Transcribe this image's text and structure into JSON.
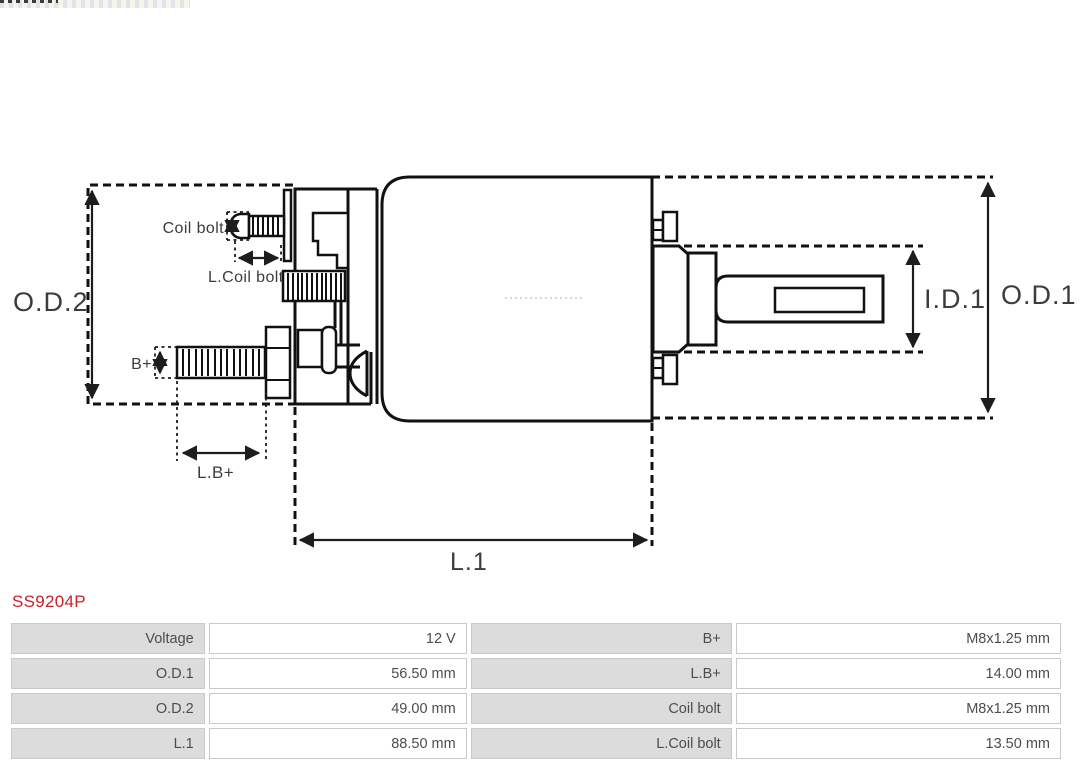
{
  "part_number": "SS9204P",
  "diagram": {
    "labels": {
      "od2": "O.D.2",
      "od1": "O.D.1",
      "id1": "I.D.1",
      "l1": "L.1",
      "b_plus": "B+",
      "l_b_plus": "L.B+",
      "coil_bolt": "Coil bolt",
      "l_coil_bolt": "L.Coil bolt"
    },
    "line_color": "#111111",
    "label_color": "#3c3c3c"
  },
  "spec_table": {
    "rows": [
      {
        "label_left": "Voltage",
        "value_left": "12 V",
        "label_right": "B+",
        "value_right": "M8x1.25 mm"
      },
      {
        "label_left": "O.D.1",
        "value_left": "56.50 mm",
        "label_right": "L.B+",
        "value_right": "14.00 mm"
      },
      {
        "label_left": "O.D.2",
        "value_left": "49.00 mm",
        "label_right": "Coil bolt",
        "value_right": "M8x1.25 mm"
      },
      {
        "label_left": "L.1",
        "value_left": "88.50 mm",
        "label_right": "L.Coil bolt",
        "value_right": "13.50 mm"
      }
    ],
    "colors": {
      "label_bg": "#dcdcdc",
      "cell_border": "#c9c9c9",
      "text": "#4d4d4d",
      "part_number": "#cb2027"
    }
  }
}
